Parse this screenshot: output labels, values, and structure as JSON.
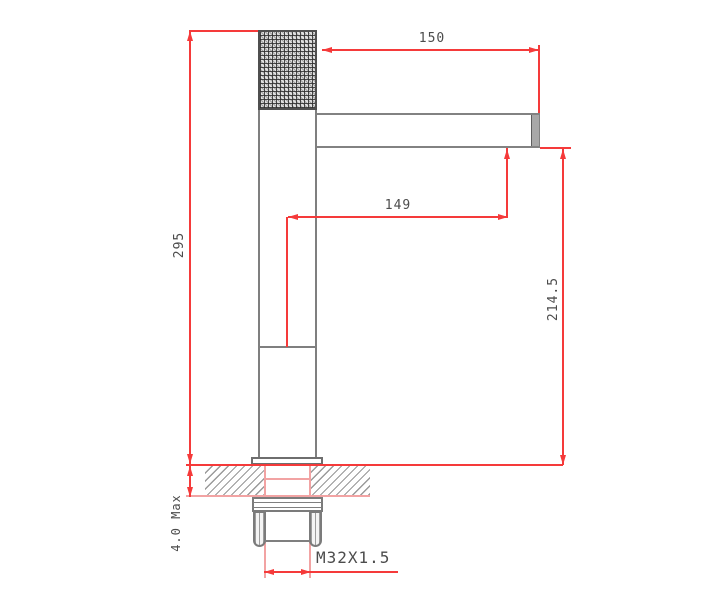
{
  "drawing": {
    "kind": "technical-dimension-drawing",
    "subject": "single-lever basin faucet, side elevation with installation section",
    "dims": {
      "spout_reach": {
        "label": "150",
        "orientation": "horizontal"
      },
      "outlet_reach": {
        "label": "149",
        "orientation": "horizontal"
      },
      "overall_height": {
        "label": "295",
        "orientation": "vertical"
      },
      "outlet_height": {
        "label": "214.5",
        "orientation": "vertical"
      },
      "deck_thickness": {
        "label": "4.0 Max",
        "orientation": "vertical"
      },
      "thread": {
        "label": "M32X1.5",
        "orientation": "horizontal"
      }
    },
    "colors": {
      "dimension_line": "#f53a3a",
      "extension_line": "#f2a3a3",
      "outline_gray": "#7f7f7f",
      "outline_dark": "#4f4f4f",
      "text": "#4c4c4c",
      "background": "#ffffff"
    }
  }
}
